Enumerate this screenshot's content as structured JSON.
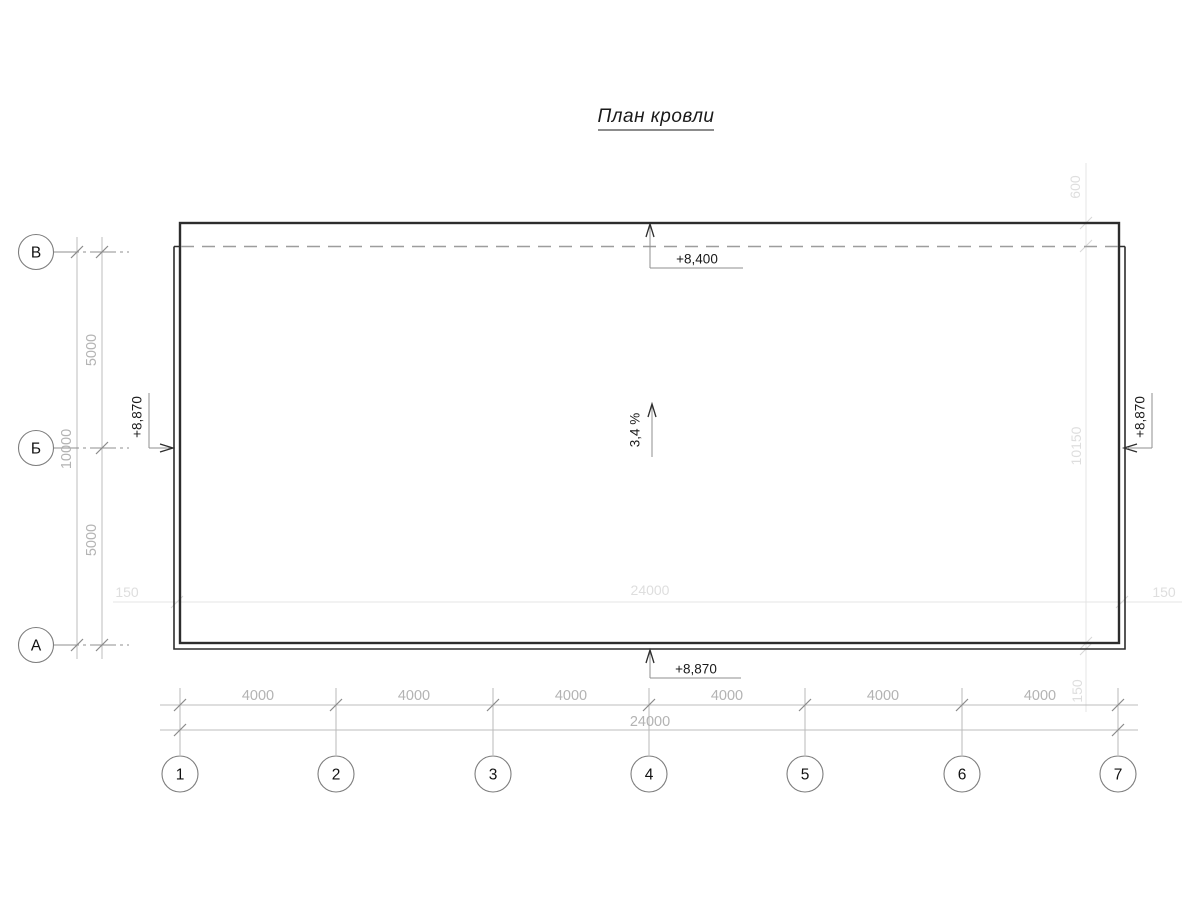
{
  "title": {
    "text": "План кровли"
  },
  "grid": {
    "row_labels": [
      "В",
      "Б",
      "А"
    ],
    "column_labels": [
      "1",
      "2",
      "3",
      "4",
      "5",
      "6",
      "7"
    ]
  },
  "dimensions": {
    "left_segments": [
      "5000",
      "5000"
    ],
    "left_total": "10000",
    "bottom_segments": [
      "4000",
      "4000",
      "4000",
      "4000",
      "4000",
      "4000"
    ],
    "bottom_total": "24000",
    "plan_width": {
      "left_overhang": "150",
      "span": "24000",
      "right_overhang": "150"
    },
    "plan_height": {
      "top_offset": "600",
      "span": "10150",
      "bottom_overhang": "150"
    }
  },
  "annotations": {
    "elevation_top": "+8,400",
    "elevation_left": "+8,870",
    "elevation_right": "+8,870",
    "elevation_bottom": "+8,870",
    "slope": "3,4 %"
  },
  "colors": {
    "outline_heavy": "#2d2d2d",
    "dimension_line": "#bdbdbd",
    "dimension_text": "#b3b3b3",
    "faint_line": "#e4e4e4",
    "faint_text": "#dedede",
    "dashed_line": "#9d9d9d",
    "annotation_text": "#1a1a1a"
  }
}
